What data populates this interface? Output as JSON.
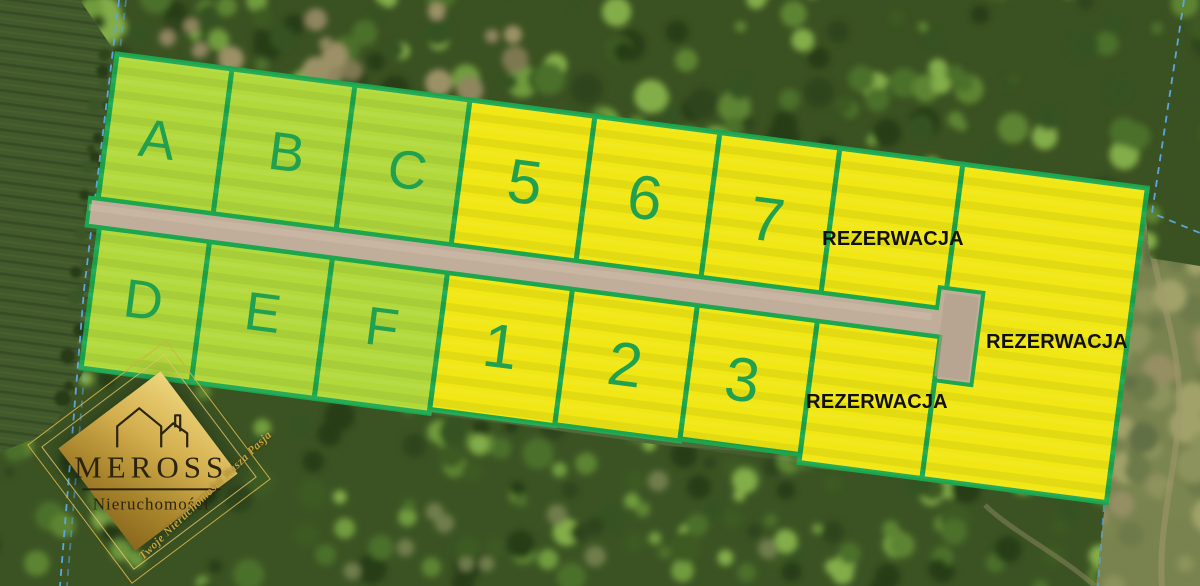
{
  "map": {
    "plots": [
      {
        "id": "A",
        "label": "A",
        "kind": "green",
        "reserved": false
      },
      {
        "id": "B",
        "label": "B",
        "kind": "green",
        "reserved": false
      },
      {
        "id": "C",
        "label": "C",
        "kind": "green",
        "reserved": false
      },
      {
        "id": "5",
        "label": "5",
        "kind": "yellow",
        "reserved": false
      },
      {
        "id": "6",
        "label": "6",
        "kind": "yellow",
        "reserved": false
      },
      {
        "id": "7",
        "label": "7",
        "kind": "yellow",
        "reserved": false
      },
      {
        "id": "rez_top",
        "label": "",
        "kind": "yellow",
        "reserved": true
      },
      {
        "id": "D",
        "label": "D",
        "kind": "green",
        "reserved": false
      },
      {
        "id": "E",
        "label": "E",
        "kind": "green",
        "reserved": false
      },
      {
        "id": "F",
        "label": "F",
        "kind": "green",
        "reserved": false
      },
      {
        "id": "1",
        "label": "1",
        "kind": "yellow",
        "reserved": false
      },
      {
        "id": "2",
        "label": "2",
        "kind": "yellow",
        "reserved": false
      },
      {
        "id": "3",
        "label": "3",
        "kind": "yellow",
        "reserved": false
      },
      {
        "id": "rez_bottom",
        "label": "",
        "kind": "yellow",
        "reserved": true
      },
      {
        "id": "rez_right",
        "label": "",
        "kind": "yellow",
        "reserved": true
      }
    ],
    "reservation_text": "REZERWACJA",
    "colors": {
      "plot_green": "#b2d93c",
      "plot_yellow": "#f1e714",
      "border_green": "#1ca64d",
      "label_green": "#21a04f",
      "reservation_text_color": "#101010",
      "road": "#c0ae9b",
      "cadastral_blue": "#5aa7df"
    }
  },
  "watermark": {
    "brand": "MEROSS",
    "subtitle": "Nieruchomości",
    "tagline": "Twoje Nieruchomości Nasza Pasja",
    "gold": "#c9a43a"
  }
}
